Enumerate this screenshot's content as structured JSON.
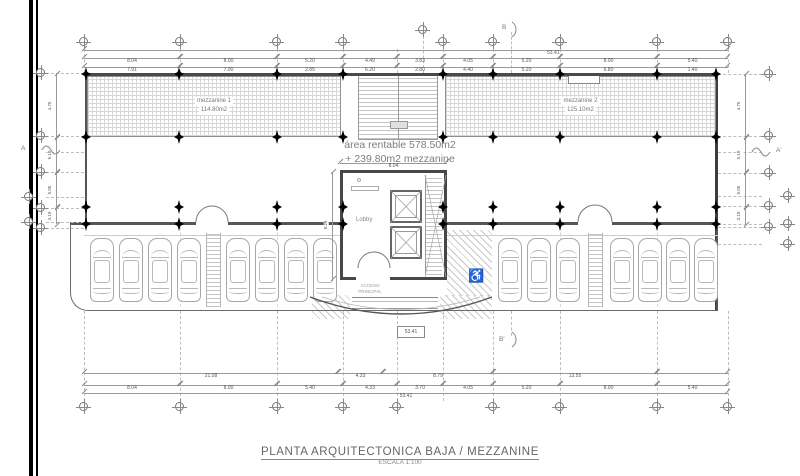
{
  "sheet": {
    "title": "PLANTA ARQUITECTONICA BAJA / MEZZANINE",
    "scale": "ESCALA 1:100"
  },
  "plan": {
    "area_line1": "área rentable  578.50m2",
    "area_line2": "+ 239.80m2 mezzanine",
    "mezz1_name": "mezzanine 1",
    "mezz1_area": "114.80m2",
    "mezz2_name": "mezzanine 2",
    "mezz2_area": "125.10m2",
    "lobby": "Lobby",
    "access1": "ACCESO",
    "access2": "PRINCIPAL",
    "boxed_total": "53.41"
  },
  "icons": {
    "wheelchair": "♿"
  },
  "markers": {
    "a": "A",
    "a_prime": "A'",
    "b": "B",
    "b_prime": "B'"
  },
  "dims": {
    "top_total": "53.41",
    "top_row1": [
      "8.04",
      "8.00",
      "5.20",
      "4.49",
      "3.83",
      "4.05",
      "5.20",
      "8.00",
      "5.40"
    ],
    "top_row2": [
      "7.91",
      "7.00",
      "2.85",
      "6.20",
      "2.80",
      "4.40",
      "5.20",
      "6.80",
      "1.40"
    ],
    "bottom_row1": [
      "21.08",
      "4.33",
      "8.79",
      "13.55",
      ""
    ],
    "bottom_row2": [
      "8.04",
      "8.00",
      "5.40",
      "4.33",
      "3.70",
      "4.05",
      "5.20",
      "8.00",
      "5.40"
    ],
    "bottom_total": "53.41",
    "left_col": [
      "4.75",
      "5.10",
      "5.05",
      "3.10"
    ],
    "right_col": [
      "4.75",
      "5.10",
      "5.05",
      "3.10"
    ],
    "lobby_width": "8.04",
    "lobby_height": "8.29"
  }
}
